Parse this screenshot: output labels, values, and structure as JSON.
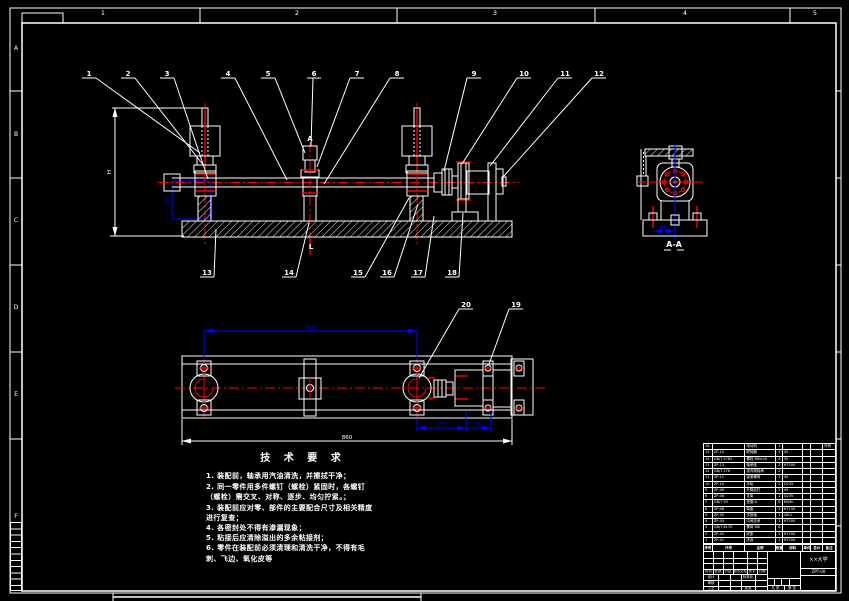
{
  "sheet": {
    "zones_top": [
      "1",
      "2",
      "3",
      "4",
      "5"
    ],
    "zones_left": [
      "A",
      "B",
      "C",
      "D",
      "E",
      "F"
    ]
  },
  "front": {
    "balloons_top": [
      "1",
      "2",
      "3",
      "4",
      "5",
      "6",
      "7",
      "8",
      "9",
      "10",
      "11",
      "12"
    ],
    "balloons_bottom": [
      "13",
      "14",
      "15",
      "16",
      "17",
      "18"
    ],
    "datum_label": "A",
    "span_label": "L",
    "height_dim": "H",
    "detail_dim": "50"
  },
  "section": {
    "label": "A-A",
    "bolt_dim": "68"
  },
  "plan": {
    "balloon_20": "20",
    "balloon_19": "19",
    "dim_span": "400",
    "dim_a": "100",
    "dim_b": "56",
    "dim_overall": "860"
  },
  "tech": {
    "title": "技 术 要 求",
    "lines": [
      "1. 装配前，轴承用汽油清洗，并擦拭干净；",
      "2. 同一零件用多件螺钉（螺栓）紧固时，各螺钉",
      "（螺栓）需交叉、对称、逐步、均匀拧紧。；",
      "3. 装配前应对零、部件的主要配合尺寸及相关精度",
      "进行复查；",
      "4. 各密封处不得有渗漏现象；",
      "5. 粘接后应清除溢出的多余粘接剂；",
      "6. 零件在装配前必须清理和清洗干净，不得有毛",
      "刺、飞边、氧化皮等"
    ]
  },
  "bom": {
    "headers": [
      "序号",
      "代号",
      "名称",
      "数量",
      "材料",
      "单件",
      "总计",
      "备注"
    ],
    "col_keys": [
      "no",
      "code",
      "name",
      "qty",
      "mat",
      "w1",
      "w2",
      "note"
    ],
    "rows": [
      {
        "no": "16",
        "code": "",
        "name": "电动机",
        "qty": "1",
        "mat": "",
        "w1": "",
        "w2": "",
        "note": "外购"
      },
      {
        "no": "15",
        "code": "ZP-15",
        "name": "联轴器",
        "qty": "1",
        "mat": "45",
        "w1": "",
        "w2": "",
        "note": ""
      },
      {
        "no": "14",
        "code": "GB/T 5782",
        "name": "螺栓 M8×20",
        "qty": "4",
        "mat": "35",
        "w1": "",
        "w2": "",
        "note": ""
      },
      {
        "no": "13",
        "code": "ZP-13",
        "name": "轴承座",
        "qty": "2",
        "mat": "HT200",
        "w1": "",
        "w2": "",
        "note": ""
      },
      {
        "no": "12",
        "code": "GB/T 276",
        "name": "深沟球轴承",
        "qty": "2",
        "mat": "",
        "w1": "",
        "w2": "",
        "note": ""
      },
      {
        "no": "11",
        "code": "ZP-11",
        "name": "锁紧螺母",
        "qty": "2",
        "mat": "45",
        "w1": "",
        "w2": "",
        "note": ""
      },
      {
        "no": "10",
        "code": "ZP-10",
        "name": "手轮",
        "qty": "2",
        "mat": "Q235",
        "w1": "",
        "w2": "",
        "note": ""
      },
      {
        "no": "9",
        "code": "ZP-09",
        "name": "升降丝杠",
        "qty": "2",
        "mat": "45",
        "w1": "",
        "w2": "",
        "note": ""
      },
      {
        "no": "8",
        "code": "ZP-08",
        "name": "支架",
        "qty": "1",
        "mat": "Q235",
        "w1": "",
        "w2": "",
        "note": ""
      },
      {
        "no": "7",
        "code": "GB/T 93",
        "name": "垫圈 8",
        "qty": "8",
        "mat": "65Mn",
        "w1": "",
        "w2": "",
        "note": ""
      },
      {
        "no": "6",
        "code": "ZP-06",
        "name": "端盖",
        "qty": "2",
        "mat": "HT150",
        "w1": "",
        "w2": "",
        "note": ""
      },
      {
        "no": "5",
        "code": "ZP-05",
        "name": "试验轴",
        "qty": "1",
        "mat": "40Cr",
        "w1": "",
        "w2": "",
        "note": ""
      },
      {
        "no": "4",
        "code": "ZP-04",
        "name": "中间支承",
        "qty": "1",
        "mat": "HT200",
        "w1": "",
        "w2": "",
        "note": ""
      },
      {
        "no": "3",
        "code": "GB/T 6170",
        "name": "螺母 M8",
        "qty": "8",
        "mat": "",
        "w1": "",
        "w2": "",
        "note": ""
      },
      {
        "no": "2",
        "code": "ZP-02",
        "name": "底座",
        "qty": "1",
        "mat": "HT200",
        "w1": "",
        "w2": "",
        "note": ""
      },
      {
        "no": "1",
        "code": "ZP-01",
        "name": "床身",
        "qty": "1",
        "mat": "HT200",
        "w1": "",
        "w2": "",
        "note": ""
      }
    ]
  },
  "titleblock": {
    "rev_row": [
      "标记",
      "处数",
      "分区",
      "更改文件号",
      "签字",
      "日期"
    ],
    "design": "设计",
    "audit": "审核",
    "process": "工艺",
    "standard": "标准化",
    "approve": "批准",
    "total_sheets": "共 张",
    "page_no": "第 张",
    "org": "××大学",
    "code": "ZPT-00"
  }
}
